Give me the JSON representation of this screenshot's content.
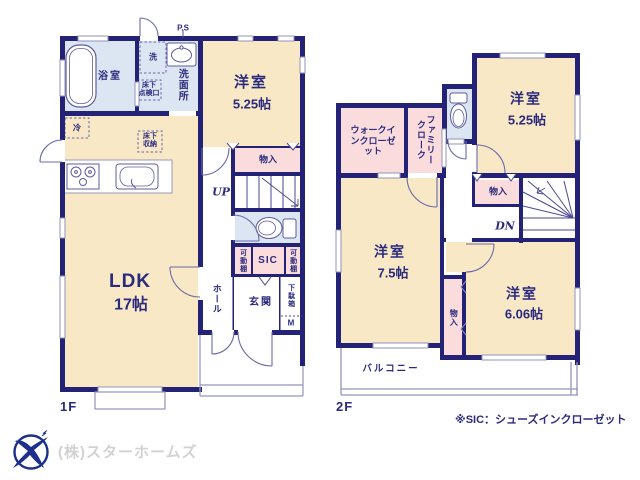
{
  "colors": {
    "wall_navy": "#232277",
    "room_cream": "#f8e8c6",
    "closet_pink": "#fadcdc",
    "wet_blue": "#dce6f3",
    "text_navy": "#2b2b7e"
  },
  "floor1": {
    "floor_label": "1F",
    "ps": "P.S",
    "bath": "浴室",
    "washer": "洗",
    "washroom": "洗面所",
    "hatch": "床下\n点検口",
    "fridge": "冷",
    "floor_storage": "床下\n収納",
    "western_room": {
      "name": "洋室",
      "size": "5.25帖"
    },
    "closet": "物入",
    "up": "UP",
    "shelf_left": "可動棚",
    "sic": "SIC",
    "shelf_right": "可動棚",
    "shoe_box": "下駄箱",
    "mirror": "M",
    "hall": "ホール",
    "entrance": "玄関",
    "ldk": {
      "name": "LDK",
      "size": "17帖"
    }
  },
  "floor2": {
    "floor_label": "2F",
    "walk_in_closet": "ウォークインクローゼット",
    "family_cloak": "ファミリークローク",
    "room_a": {
      "name": "洋室",
      "size": "5.25帖"
    },
    "closet_upper": "物入",
    "dn": "DN",
    "room_b": {
      "name": "洋室",
      "size": "7.5帖"
    },
    "closet_lower": "物入",
    "room_c": {
      "name": "洋室",
      "size": "6.06帖"
    },
    "balcony": "バルコニー"
  },
  "footer": {
    "company": "(株)スターホームズ",
    "sic_note": "※SIC：シューズインクローゼット"
  }
}
